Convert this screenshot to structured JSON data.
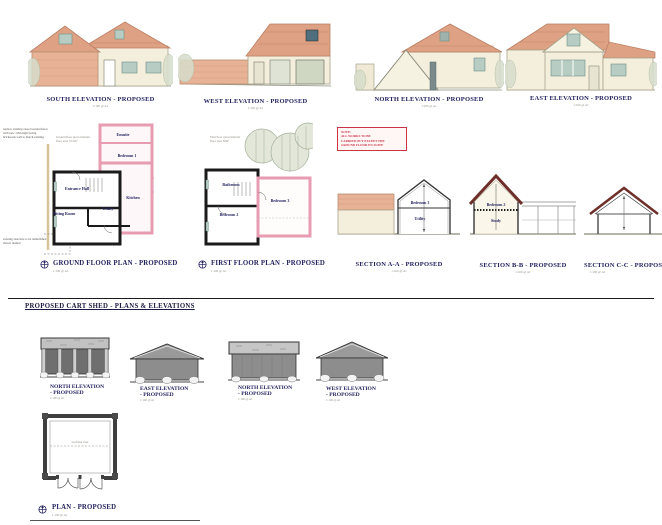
{
  "house": {
    "elevations": [
      {
        "title": "SOUTH ELEVATION - PROPOSED",
        "scale": "1:100 @ A1"
      },
      {
        "title": "WEST ELEVATION - PROPOSED",
        "scale": "1:100 @ A1"
      },
      {
        "title": "NORTH ELEVATION - PROPOSED",
        "scale": "1:100 @ A1"
      },
      {
        "title": "EAST ELEVATION - PROPOSED",
        "scale": "1:100 @ A1"
      }
    ],
    "note_box": {
      "lines": [
        "NOTE:",
        "ALL WORKS TO BE",
        "CARRIED OUT EXCEPT THE",
        "GROUND FLOOR EN-SUITE"
      ]
    },
    "ground_floor_plan": {
      "title": "GROUND FLOOR PLAN - PROPOSED",
      "scale": "1:100 @ A1",
      "area_note": "Ground floor gross internal floor area 72.5m²",
      "annotation_fence": "replace existing close boarded fence with new 1.8m high facing brickwork wall to match existing",
      "annotation_demolish": "existing structure to be demolished shown dashed",
      "rooms": {
        "ensuite": "Ensuite",
        "bedroom1": "Bedroom 1",
        "entrance_hall": "Entrance Hall",
        "kitchen": "Kitchen",
        "utility": "Utility",
        "sitting_room": "Sitting Room"
      }
    },
    "first_floor_plan": {
      "title": "FIRST FLOOR PLAN - PROPOSED",
      "scale": "1:100 @ A1",
      "area_note": "First floor gross internal floor area 56m²",
      "rooms": {
        "bathroom": "Bathroom",
        "bedroom2": "Bedroom 2",
        "bedroom3": "Bedroom 3"
      }
    },
    "sections": [
      {
        "title": "SECTION A-A - PROPOSED",
        "scale": "1:100 @ A1",
        "rooms": [
          "Bedroom 3",
          "Utility"
        ]
      },
      {
        "title": "SECTION B-B - PROPOSED",
        "scale": "1:100 @ A1",
        "rooms": [
          "Bedroom 2",
          "Study"
        ]
      },
      {
        "title": "SECTION C-C - PROPOSED",
        "scale": "1:100 @ A1",
        "rooms": []
      }
    ]
  },
  "cart_shed": {
    "heading": "PROPOSED CART SHED - PLANS & ELEVATIONS",
    "elevations": [
      {
        "title_line1": "NORTH ELEVATION",
        "title_line2": "- PROPOSED",
        "scale": "1:100 @ A1"
      },
      {
        "title_line1": "EAST ELEVATION",
        "title_line2": "- PROPOSED",
        "scale": "1:100 @ A1"
      },
      {
        "title_line1": "NORTH ELEVATION",
        "title_line2": "- PROPOSED",
        "scale": "1:100 @ A1"
      },
      {
        "title_line1": "WEST ELEVATION",
        "title_line2": "- PROPOSED",
        "scale": "1:100 @ A1"
      }
    ],
    "plan": {
      "title": "PLAN - PROPOSED",
      "scale": "1:100 @ A1",
      "annotation": "roof line over"
    }
  },
  "colors": {
    "title_navy": "#23235f",
    "roof_terracotta": "#dfa184",
    "wall_cream": "#f4efdd",
    "brick_pink": "#e7b296",
    "window_teal": "#b7cdc4",
    "plan_pink_wall": "#e79cb2",
    "plan_black_wall": "#1b1b1b",
    "shed_grey": "#8d8d8d",
    "note_red": "#cc3344",
    "section_rafter_maroon": "#6e2f2a"
  }
}
